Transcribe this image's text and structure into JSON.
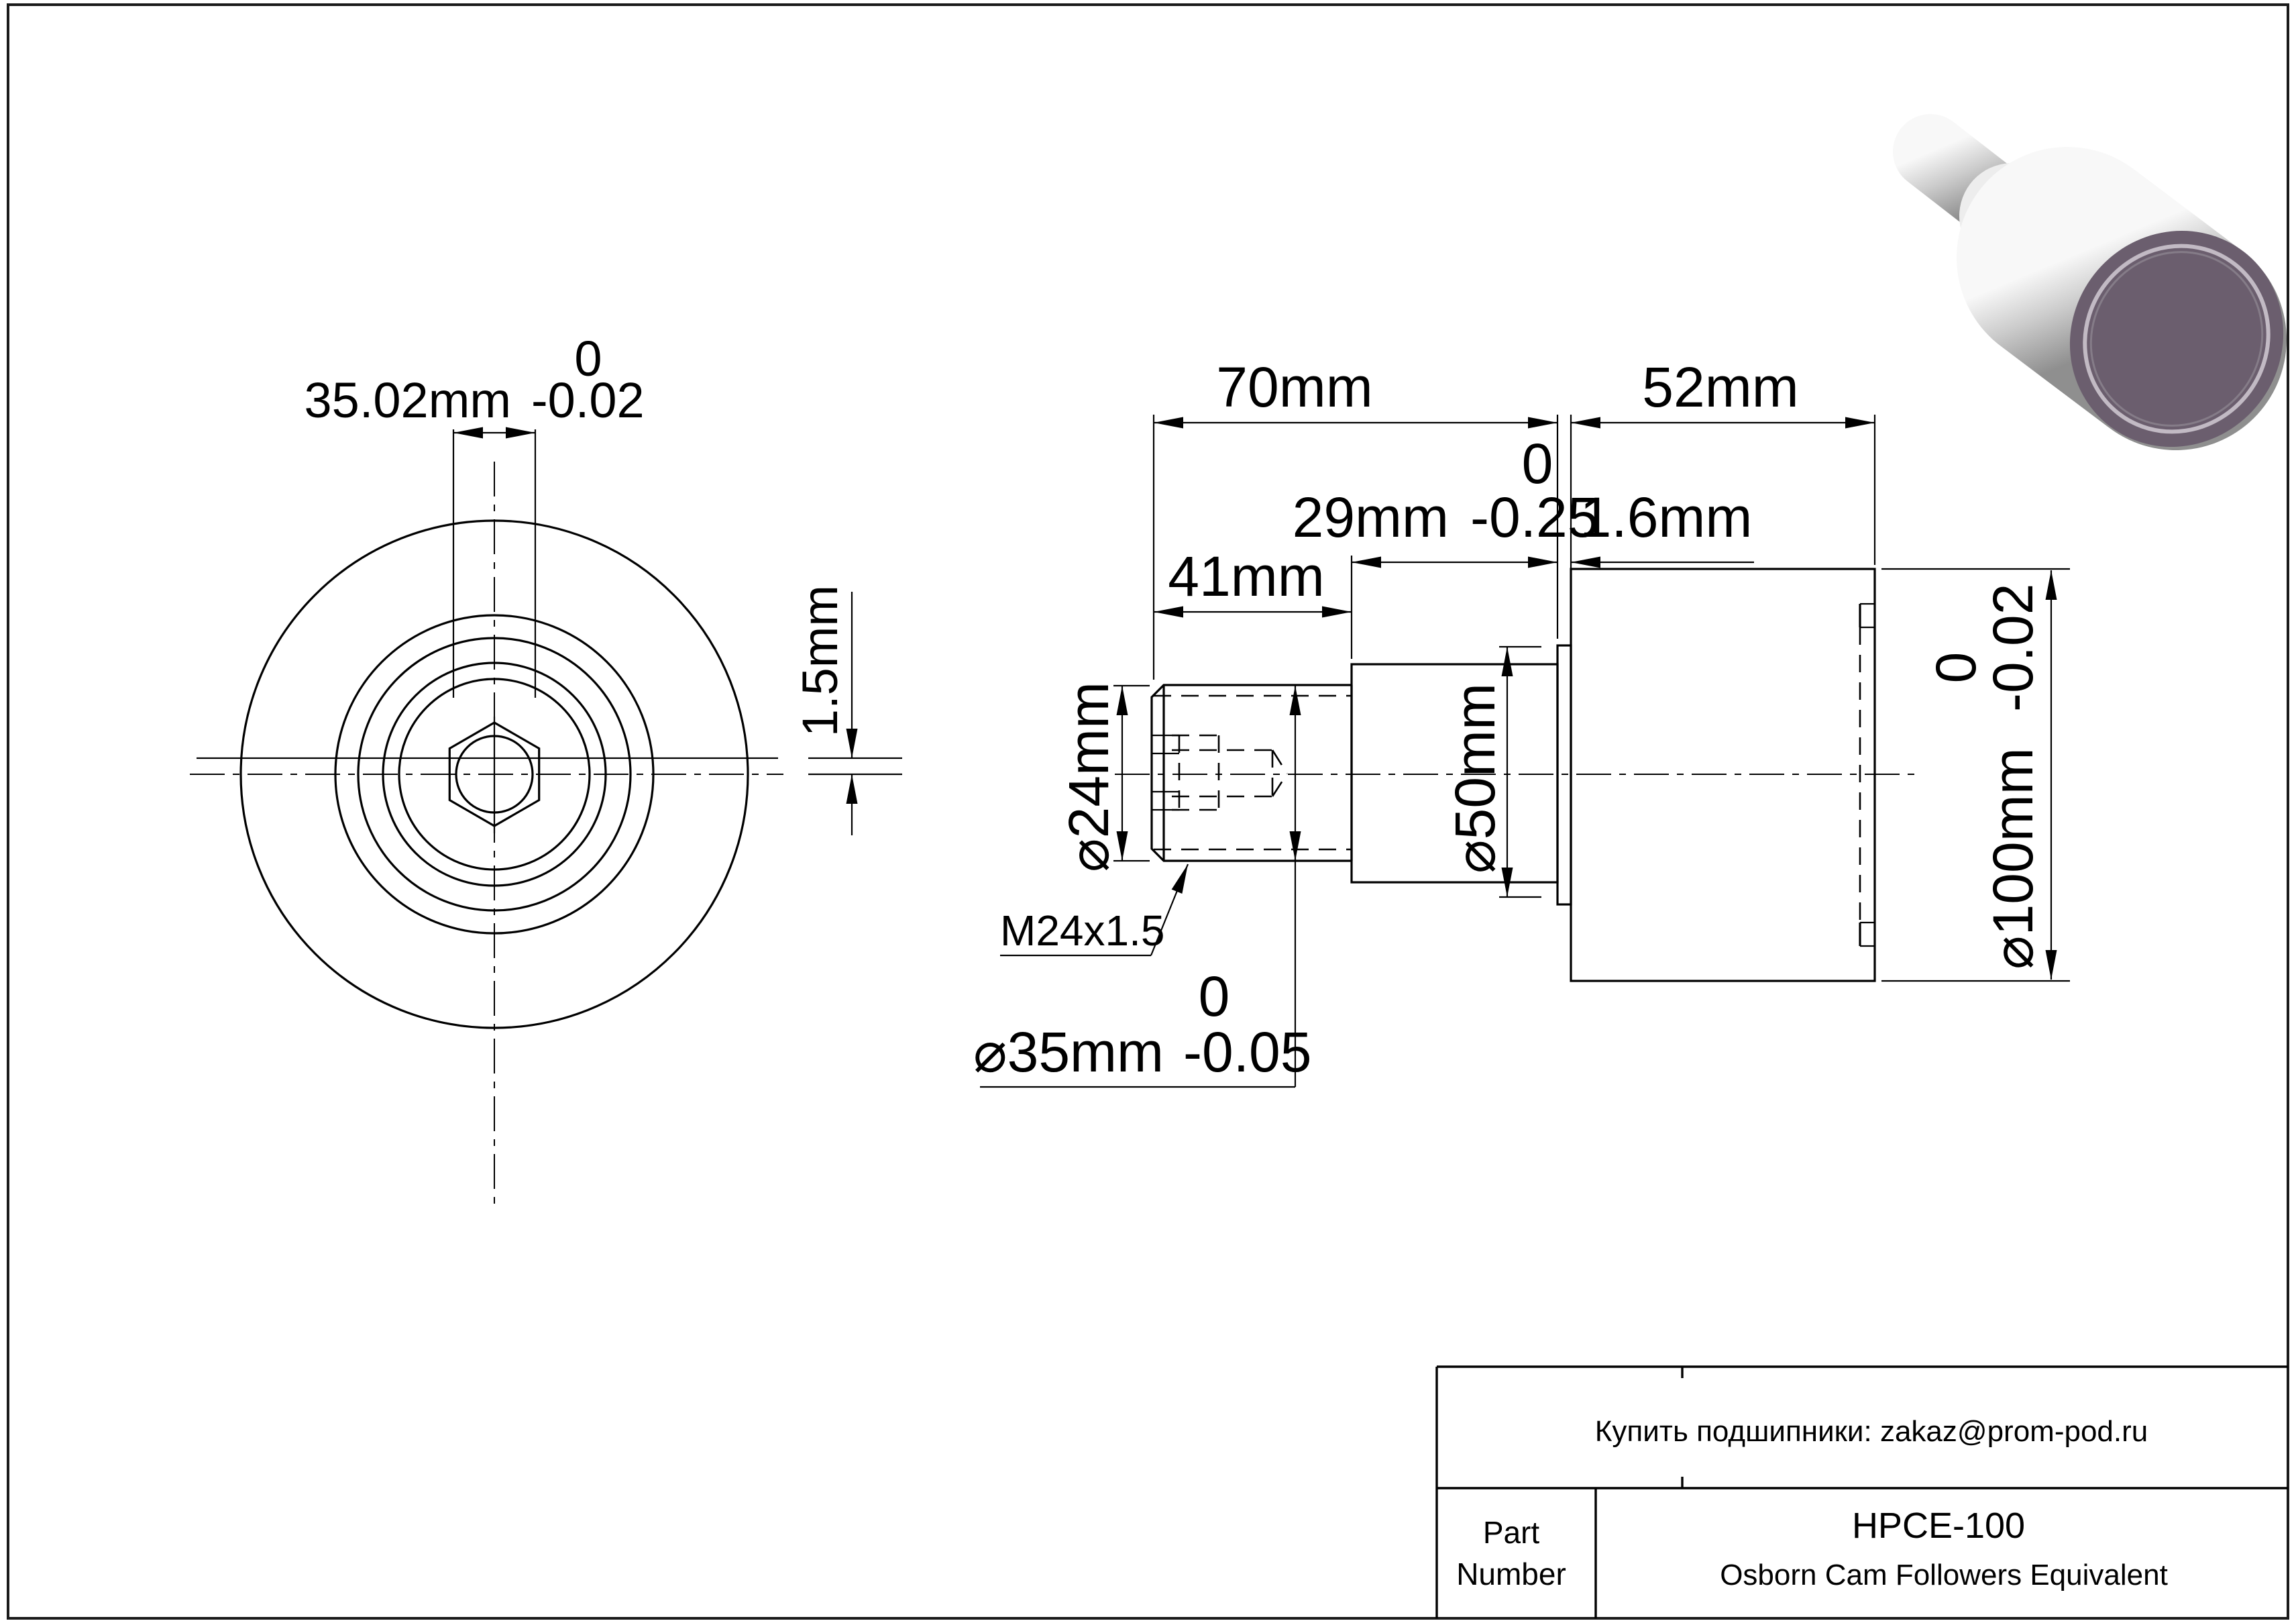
{
  "drawing": {
    "front_view": {
      "width_dim": {
        "value": "35.02mm",
        "tol_upper": "0",
        "tol_lower": "-0.02"
      },
      "offset_dim": "1.5mm"
    },
    "side_view": {
      "total_length": "70mm",
      "roller_width": "52mm",
      "flange_width": {
        "value": "29mm",
        "tol_upper": "0",
        "tol_lower": "-0.25"
      },
      "washer_thickness": "1.6mm",
      "thread_length": "41mm",
      "thread_minor_dia": "⌀24mm",
      "thread_spec": "M24x1.5",
      "stud_dia": {
        "value": "⌀35mm",
        "tol_upper": "0",
        "tol_lower": "-0.05"
      },
      "flange_dia": "⌀50mm",
      "roller_dia": {
        "value": "⌀100mm",
        "tol_upper": "0",
        "tol_lower": "-0.02"
      }
    },
    "colors": {
      "line": "#000000",
      "background": "#ffffff",
      "render_face": "#6b5e6e",
      "render_metal_light": "#f8f8f8",
      "render_metal_dark": "#8f8f8f"
    }
  },
  "title_block": {
    "note": "Купить подшипники: zakaz@prom-pod.ru",
    "part_label_line1": "Part",
    "part_label_line2": "Number",
    "part_number": "HPCE-100",
    "description": "Osborn Cam Followers Equivalent"
  }
}
